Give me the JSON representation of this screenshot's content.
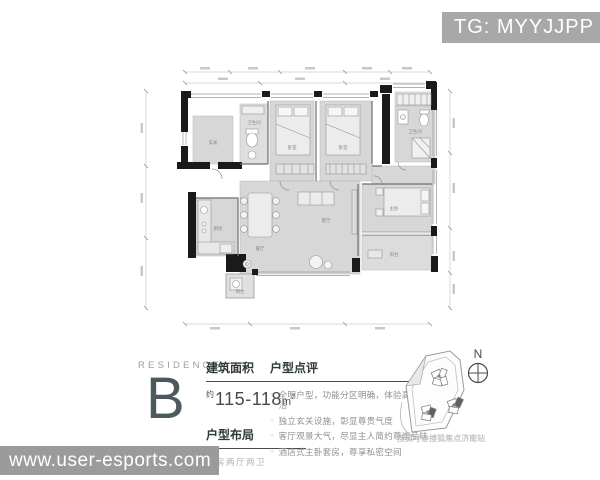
{
  "badge": {
    "text": "TG: MYYJJPP"
  },
  "footer_watermark": {
    "text": "www.user-esports.com"
  },
  "residence": {
    "label": "RESIDENCE",
    "letter": "B"
  },
  "area": {
    "heading": "建筑面积",
    "approx": "约",
    "value": "115-118",
    "unit": "m",
    "sup": "2"
  },
  "layout": {
    "heading": "户型布局",
    "value": "四房两厅两卫"
  },
  "review": {
    "heading": "户型点评",
    "bullets": [
      "全明户型，功能分区明确，体验高尚生活",
      "独立玄关设施，彰显尊贵气度",
      "客厅观景大气，尽显主人简约尊崇品味",
      "酒店式主卧套房，尊享私密空间"
    ]
  },
  "site_plan": {
    "compass": "N",
    "watermark": "搜狐号@搜狐焦点济南站"
  },
  "floor_plan": {
    "labels": [
      "玄关",
      "卫生间",
      "卧室",
      "卧室",
      "卫生间",
      "厨房",
      "餐厅",
      "客厅",
      "主卧",
      "阳台",
      "阳台"
    ]
  },
  "colors": {
    "badge_bg": "#a8a8a8",
    "footer_bg": "#9b9b9b",
    "residence_letter": "#4c5a5e",
    "wall": "#1a1a1a",
    "room_fill": "#d7d7d7"
  }
}
